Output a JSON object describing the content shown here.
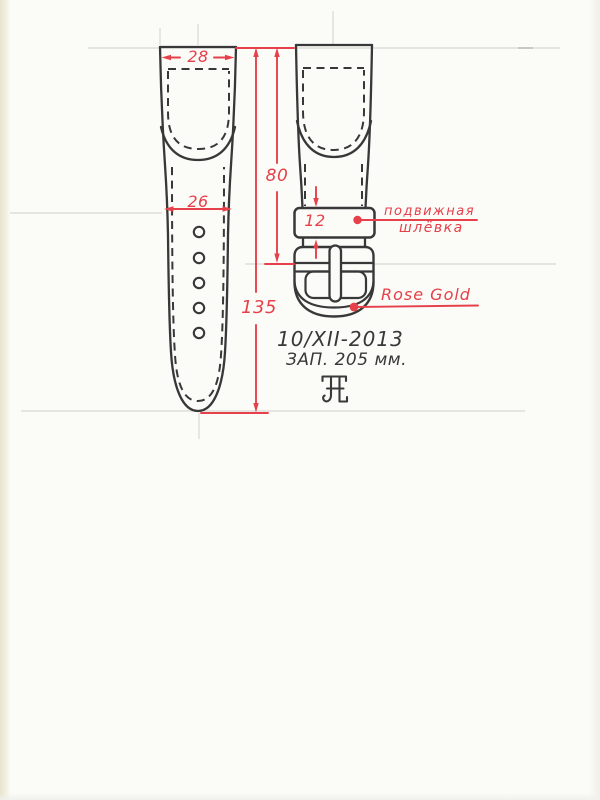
{
  "dimensions": {
    "strap_top_width": "28",
    "strap_lower_width": "26",
    "length_to_buckle": "80",
    "keeper_height": "12",
    "strap_total_length": "135"
  },
  "labels": {
    "keeper_line1": "подвижная",
    "keeper_line2": "шлёвка",
    "buckle_material": "Rose Gold"
  },
  "notes": {
    "date": "10/XII-2013",
    "clasp_note": "ЗАП. 205 мм."
  },
  "icons": {
    "brand_monogram": "jl-monogram-icon"
  },
  "colors": {
    "ink": "#383838",
    "annotation_red": "#e6404a",
    "paper": "#fbfbf8",
    "paper_edge": "#ece8d4",
    "guide_line": "#d9d9d3"
  }
}
